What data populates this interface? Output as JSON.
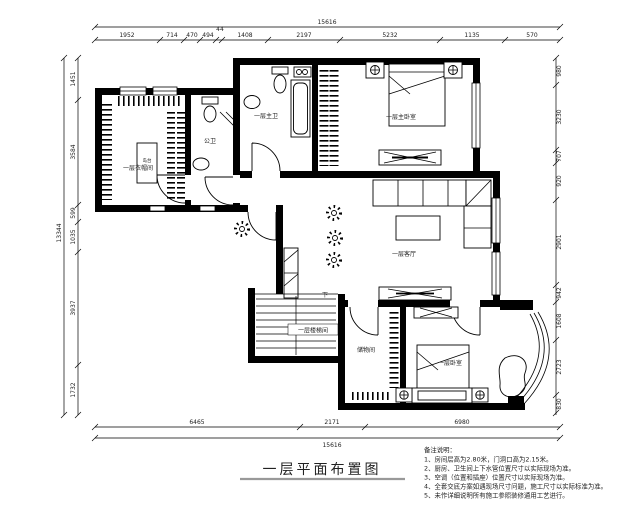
{
  "title": {
    "text": "一层平面布置图"
  },
  "rooms": {
    "cloakroom": "一层衣帽间",
    "cloakroom_island": "岛台",
    "guest_bath": "公卫",
    "master_bath": "一层主卫",
    "master_bedroom": "一层主卧室",
    "living_room": "一层客厅",
    "stairwell": "一层楼梯间",
    "stairs_down": "下",
    "storage": "储物间",
    "bedroom": "一层卧室"
  },
  "dimensions": {
    "top": {
      "total": "15616",
      "segments": [
        "1952",
        "714",
        "470",
        "494",
        "44",
        "1408",
        "2197",
        "5232",
        "1135",
        "570"
      ]
    },
    "bottom": {
      "total": "15616",
      "segments": [
        "6465",
        "2171",
        "6980"
      ]
    },
    "left": {
      "total": "13344",
      "segments": [
        "1451",
        "3584",
        "599",
        "1035",
        "3937",
        "1732"
      ]
    },
    "right": {
      "segments": [
        "980",
        "3230",
        "707",
        "920",
        "2901",
        "942",
        "1608",
        "2723",
        "830"
      ]
    }
  },
  "notes": {
    "heading": "备注说明：",
    "items": [
      "1、房间层高为2.80米，门洞口高为2.15米。",
      "2、厨房、卫生间上下水管位置尺寸以实际现场为准。",
      "3、空调（位置和插座）位置尺寸以实际现场为准。",
      "4、全套交底方案如遇现场尺寸问题，施工尺寸以实际标准为准。",
      "5、未作详细说明所有施工参照装修通用工艺进行。"
    ]
  },
  "colors": {
    "wall": "#000000",
    "background": "#ffffff",
    "dim_text": "#222222"
  }
}
